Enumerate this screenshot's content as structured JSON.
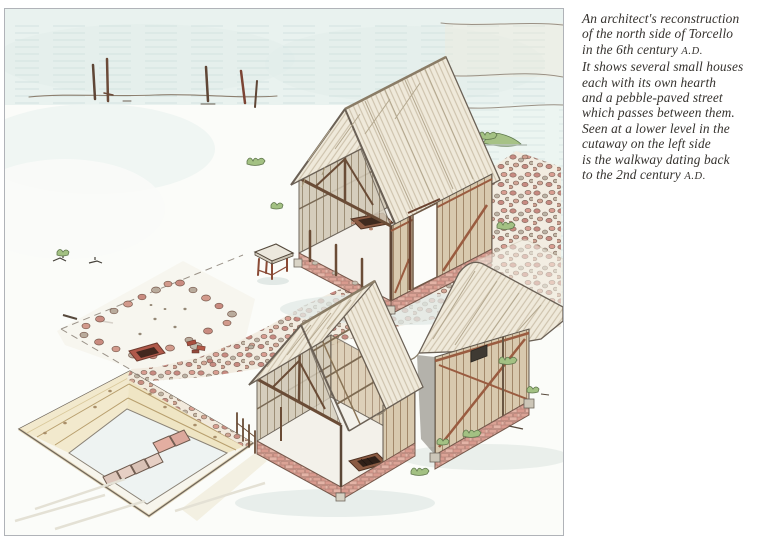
{
  "page": {
    "width": 771,
    "height": 554,
    "background": "#ffffff"
  },
  "figure": {
    "type": "hand-drawn archaeological reconstruction illustration",
    "alt": "Isometric pencil-and-watercolour drawing of early-medieval Torcello: three small thatched timber houses (two shown in cutaway with central hearths), a pebble-paved street passing between them, a rectangular stone foundation outline with a hearth, mooring posts in the lagoon, and an excavation trench revealing a Roman walkway",
    "border_color": "#b0b3b8",
    "palette": {
      "water_wash": "#e9f2ef",
      "water_lines": "#d2e3e0",
      "ground": "#f6f5ef",
      "thatch": "#efe9da",
      "thatch_stroke": "#c9bda6",
      "plank": "#d8c9ae",
      "plank_line": "#9c8163",
      "timber_red": "#9a5c40",
      "post_brown": "#5f4636",
      "brick": "#e0aca0",
      "pebble_red": "#c5847b",
      "pebble_grey": "#b7aea0",
      "grass": "#a3c183",
      "strata_cream": "#f2e9cd",
      "strata_tan": "#b89f6e",
      "walkway_slab": "#e3aea1",
      "ink": "#6b6156",
      "shadow": "#e2e9e6"
    },
    "parts": [
      "lagoon water with wave lines",
      "shoreline",
      "wooden mooring posts",
      "small green island",
      "upper cutaway house with hearth and doorway",
      "pebble-paved street",
      "stone foundation outline with hearth",
      "small wooden table",
      "excavation trench with strata",
      "2nd-century walkway slabs",
      "lower cutaway house with hearth and open roof frame",
      "timber-framed house with window",
      "grass tufts"
    ]
  },
  "caption": {
    "text_color": "#35322e",
    "lines": [
      "An architect's reconstruction",
      "of the north side of Torcello",
      "in the 6th century A.D.",
      "It shows several small houses",
      "each with its own hearth",
      "and a pebble-paved street",
      "which passes between them.",
      "Seen at a lower level in the",
      "cutaway on the left side",
      "is the walkway dating back",
      "to the 2nd century A.D."
    ]
  }
}
